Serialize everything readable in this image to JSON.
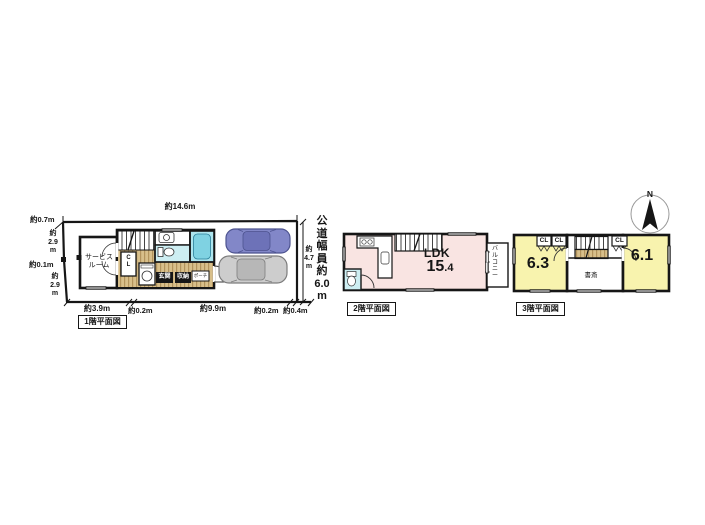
{
  "colors": {
    "wall": "#161616",
    "ldk-pink": "#f9e4e2",
    "room-yellow": "#f8f3ae",
    "water-light": "#cdeef2",
    "water-mid": "#aee6ef",
    "water-deep": "#7fd2e2",
    "wood-tan": "#d8bf8a",
    "wood-tan-dark": "#b2935c",
    "car-blue": "#8287c8",
    "car-gray": "#cdcdcd"
  },
  "compass": {
    "north": "N"
  },
  "road": {
    "label": "公\n道\n幅\n員\n約\n6.0\nm"
  },
  "floor1": {
    "title": "1階平面図",
    "rooms": {
      "service": "サービス\nルーム",
      "closet": "C\nL",
      "entrance": "玄関",
      "storage": "収納",
      "porch": "ポーチ"
    },
    "dims": {
      "top": "約14.6m",
      "top_left": "約0.7m",
      "left_upper": "約\n2.9\nm",
      "left_mid": "約0.1m",
      "left_lower": "約\n2.9\nm",
      "right": "約\n4.7\nm",
      "bottom1": "約3.9m",
      "bottom2": "約0.2m",
      "bottom3": "約9.9m",
      "bottom4": "約0.2m",
      "bottom5": "約0.4m"
    }
  },
  "floor2": {
    "title": "2階平面図",
    "rooms": {
      "ldk": "LDK",
      "ldk_size_int": "15",
      "ldk_size_frac": ".4",
      "balcony": "バ\nル\nコ\nニ\nー"
    }
  },
  "floor3": {
    "title": "3階平面図",
    "rooms": {
      "left_size": "6.3",
      "right_size": "6.1",
      "cl1": "CL",
      "cl2": "CL",
      "cl3": "CL",
      "study": "書斎"
    }
  }
}
